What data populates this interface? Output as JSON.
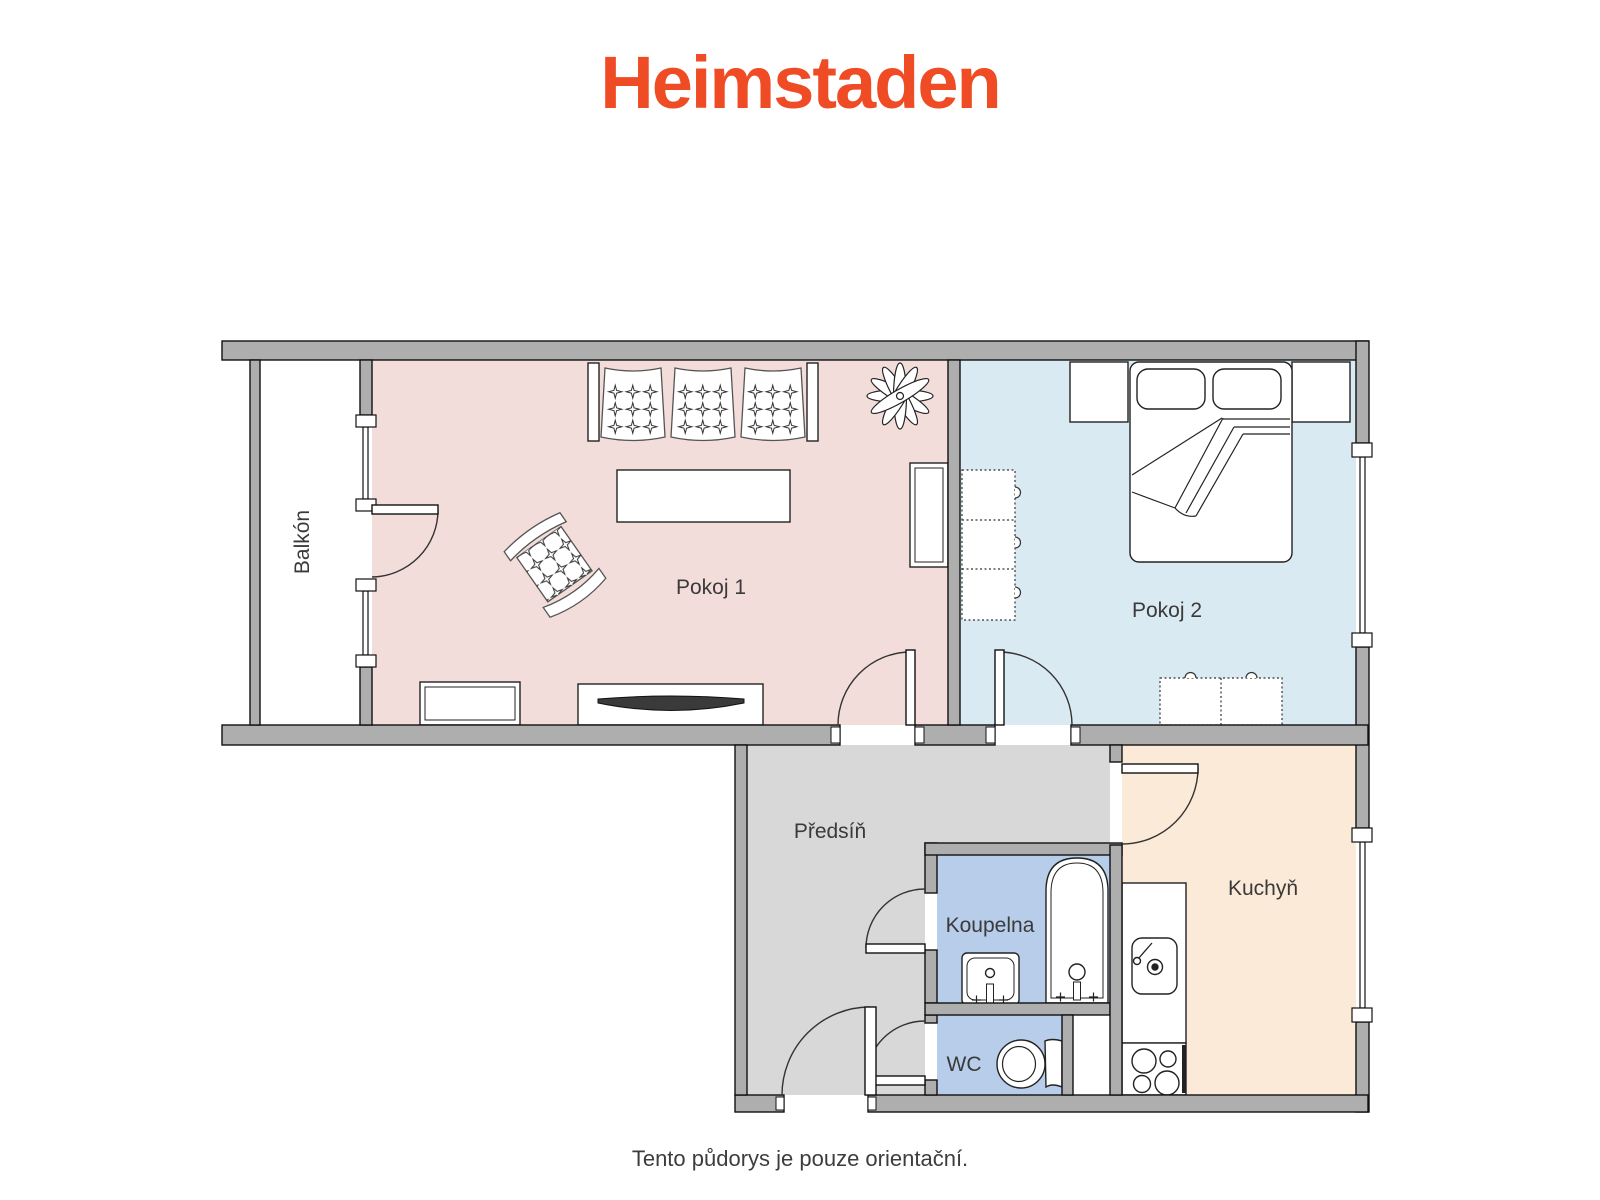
{
  "brand": {
    "logo_text": "Heimstaden",
    "logo_color": "#ef4b25"
  },
  "floorplan": {
    "wall_color": "#aeaeae",
    "outline_color": "#111111",
    "label_color": "#3a3a3a",
    "rooms": [
      {
        "id": "balkon",
        "label": "Balkón",
        "floor_color": "#ffffff"
      },
      {
        "id": "pokoj-1",
        "label": "Pokoj 1",
        "floor_color": "#f2ddda"
      },
      {
        "id": "pokoj-2",
        "label": "Pokoj 2",
        "floor_color": "#daeaf2"
      },
      {
        "id": "predsin",
        "label": "Předsíň",
        "floor_color": "#d8d8d8"
      },
      {
        "id": "koupelna",
        "label": "Koupelna",
        "floor_color": "#b7cde9"
      },
      {
        "id": "wc",
        "label": "WC",
        "floor_color": "#b7cde9"
      },
      {
        "id": "kuchyn",
        "label": "Kuchyň",
        "floor_color": "#fcead9"
      }
    ]
  },
  "footer": {
    "disclaimer": "Tento půdorys je pouze orientační."
  }
}
